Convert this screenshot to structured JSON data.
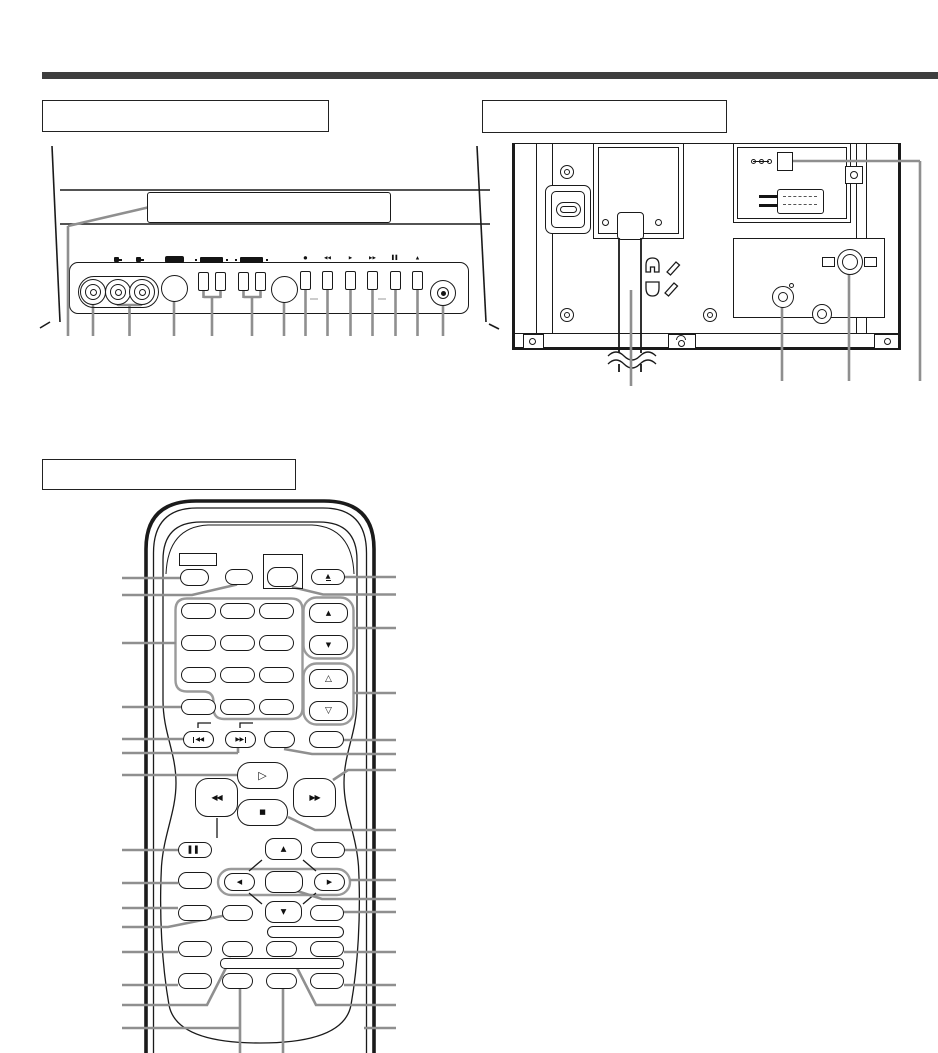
{
  "page": {
    "description": "TV/VCR owner's manual diagram page with three line-art illustrations",
    "colors": {
      "ink": "#1a1a1a",
      "leader": "#8f8f8f",
      "rule": "#3e3e3e",
      "group_outline": "#9a9a9a",
      "paper": "#ffffff"
    },
    "sections": {
      "front_panel": {
        "label": ""
      },
      "rear_panel": {
        "label": ""
      },
      "remote": {
        "label": ""
      }
    }
  },
  "front_panel": {
    "label": "",
    "glyphs": {
      "record": "●",
      "rewind": "◀◀",
      "play": "▶",
      "fast_forward": "▶▶",
      "pause": "▌▌",
      "eject": "▲"
    }
  },
  "rear_panel": {
    "label": ""
  },
  "remote": {
    "label": "",
    "glyphs": {
      "eject": "▲",
      "volume_up": "▲",
      "volume_down": "▼",
      "channel_up": "△",
      "channel_down": "▽",
      "skip_back": "◀◀",
      "skip_forward": "▶▶",
      "play": "▷",
      "rewind": "◀◀",
      "fast_forward": "▶▶",
      "stop": "■",
      "pause": "▌▌",
      "nav_up": "▲",
      "nav_down": "▼",
      "nav_left": "◀",
      "nav_right": "▶"
    }
  }
}
